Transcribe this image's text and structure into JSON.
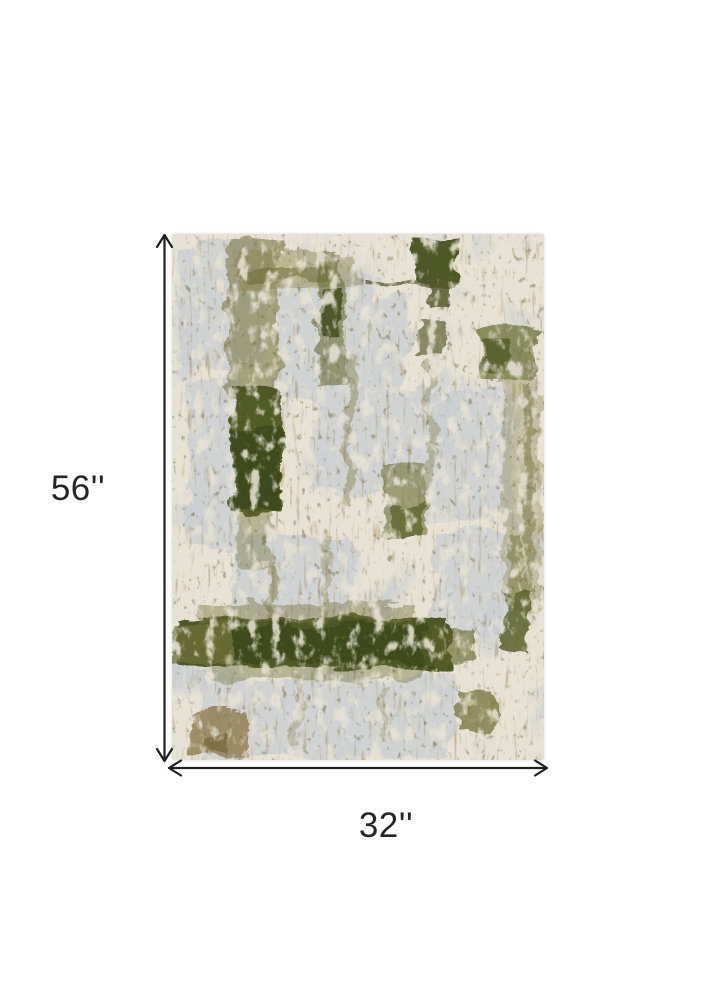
{
  "diagram": {
    "height_label": "56''",
    "width_label": "32''",
    "arrow_color": "#1f1f1f",
    "label_color": "#262626",
    "icons": {
      "height_arrow": "double-headed-vertical-arrow-icon",
      "width_arrow": "double-headed-horizontal-arrow-icon"
    }
  },
  "rug": {
    "colors": {
      "ivory": "#e7e2d3",
      "gray": "#c9ced3",
      "olive": "#6d7134",
      "dark_olive": "#47511f",
      "tan": "#8f7a4d"
    }
  }
}
